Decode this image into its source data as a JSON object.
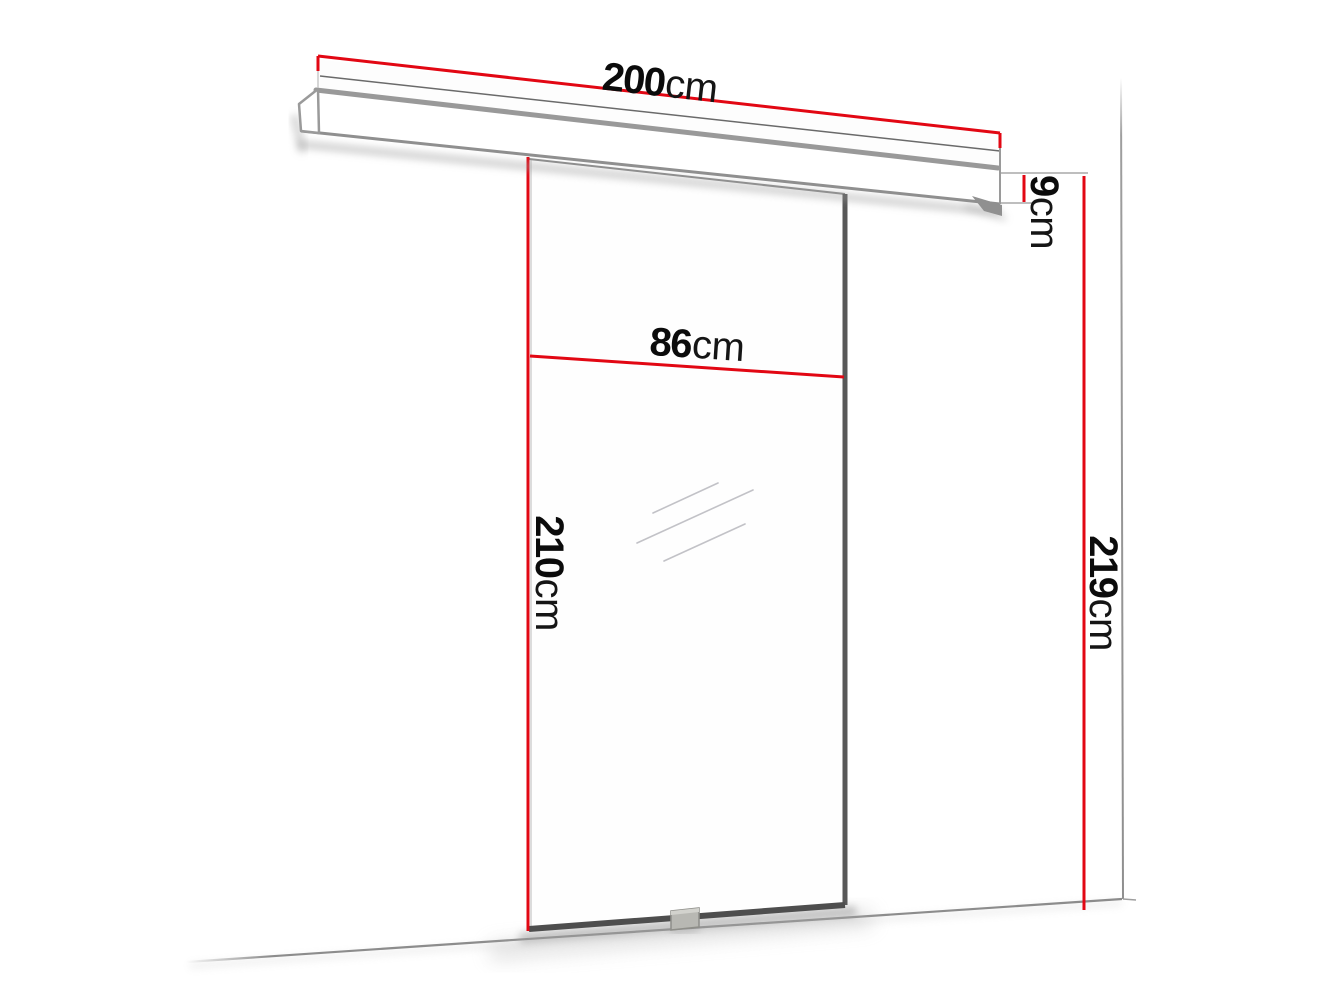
{
  "page": {
    "background": "#ffffff"
  },
  "colors": {
    "dimension_line_red": "#e20713",
    "outline_gray": "#8c8c8c",
    "door_edge_dark": "#4e4e4e",
    "handle_gray": "#b8b8b3",
    "text_black": "#0b0b0b"
  },
  "dimensions": {
    "track_width": {
      "value": "200",
      "unit": "cm"
    },
    "track_height": {
      "value": "9",
      "unit": "cm"
    },
    "door_width": {
      "value": "86",
      "unit": "cm"
    },
    "door_height": {
      "value": "210",
      "unit": "cm"
    },
    "total_height": {
      "value": "219",
      "unit": "cm"
    }
  }
}
